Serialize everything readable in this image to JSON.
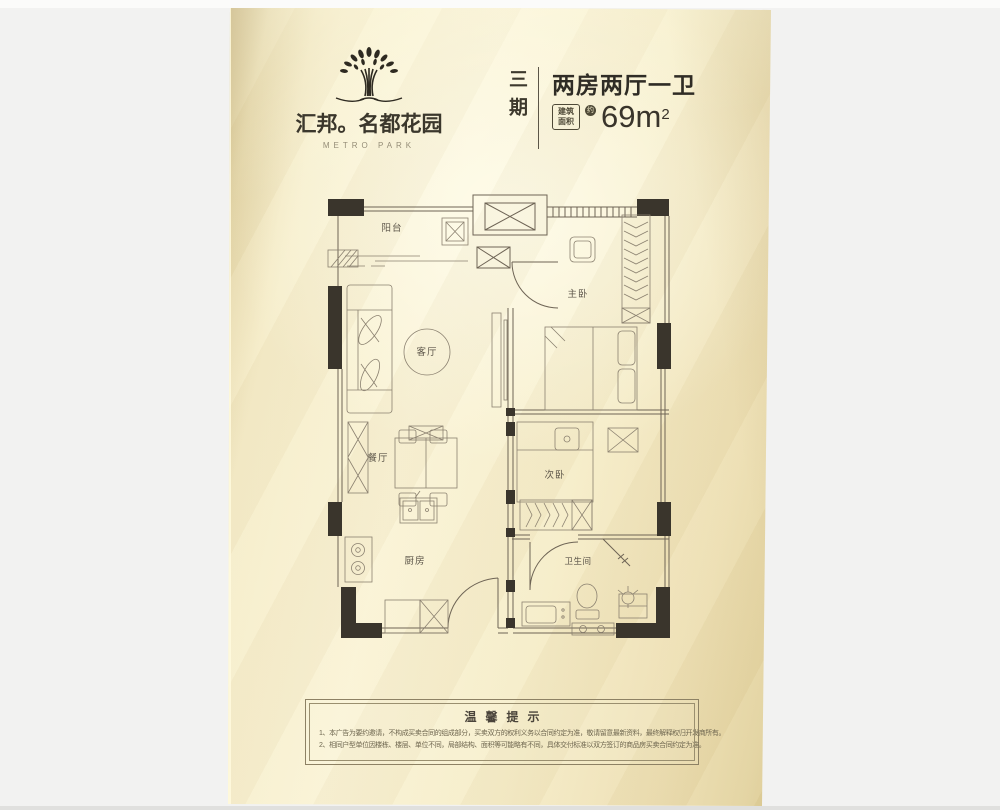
{
  "brand": {
    "logo": "tree-logo-icon",
    "name": "汇邦。名都花园",
    "name_en": "METRO PARK"
  },
  "header": {
    "phase": "三期",
    "title": "两房两厅一卫",
    "area_label_1": "建筑",
    "area_label_2": "面积",
    "approx": "约",
    "area_value": "69m",
    "area_sup": "2"
  },
  "plan": {
    "rooms": [
      {
        "label": "阳台"
      },
      {
        "label": "客厅"
      },
      {
        "label": "主卧"
      },
      {
        "label": "餐厅"
      },
      {
        "label": "次卧"
      },
      {
        "label": "厨房"
      },
      {
        "label": "卫生间"
      }
    ]
  },
  "tips": {
    "title": "温馨提示",
    "lines": [
      "1、本广告为要约邀请，不构成买卖合同的组成部分，买卖双方的权利义务以合同约定为准，敬请留意最新资料，最终解释权归开发商所有。",
      "2、相同户型单位因楼栋、楼层、单位不同，局部结构、面积等可能略有不同，具体交付标准以双方签订的商品房买卖合同约定为准。"
    ]
  },
  "colors": {
    "card_cream": "#f8f1d3",
    "card_edge": "#dccb94",
    "plan_line": "#6e6455",
    "wall_black": "#3a352c",
    "text_dark": "#35312a",
    "background": "#f2f2f1"
  }
}
